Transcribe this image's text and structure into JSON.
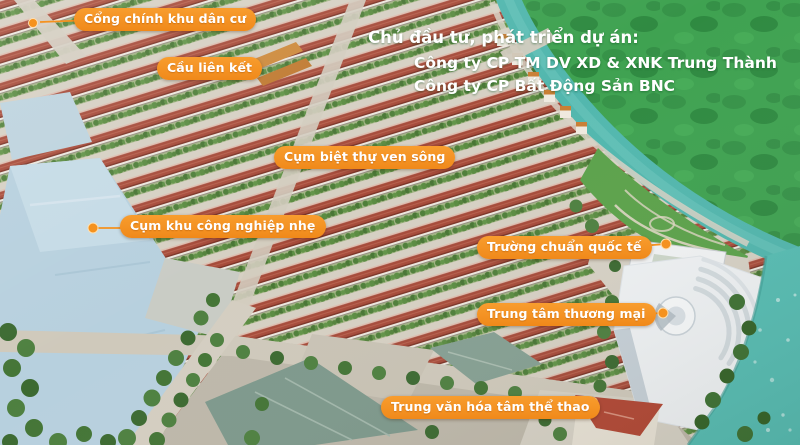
{
  "developer": {
    "heading": "Chủ đầu tư, phát triển dự án:",
    "companies": [
      "Công ty CP TM DV XD & XNK Trung Thành",
      "Công ty CP Bất Động Sản BNC"
    ]
  },
  "labels": [
    {
      "id": "main-gate",
      "text": "Cổng chính khu dân cư"
    },
    {
      "id": "link-bridge",
      "text": "Cầu liên kết"
    },
    {
      "id": "riverside-villas",
      "text": "Cụm biệt thự ven sông"
    },
    {
      "id": "light-industry",
      "text": "Cụm khu công nghiệp nhẹ"
    },
    {
      "id": "international-school",
      "text": "Trường chuẩn quốc tế"
    },
    {
      "id": "shopping-center",
      "text": "Trung tâm thương mại"
    },
    {
      "id": "culture-sports",
      "text": "Trung văn hóa tâm thể thao"
    }
  ],
  "colors": {
    "label_background": "#F5921E",
    "label_text": "#FFFFFF",
    "overlay_text": "#FFFFFF",
    "field_green": "#3FA251",
    "river_teal": "#52B7AE",
    "housing_roof_red": "#A64B3A",
    "industrial_roof_blue": "#B7D0DE",
    "warehouse_roof_green": "#7E998C"
  }
}
